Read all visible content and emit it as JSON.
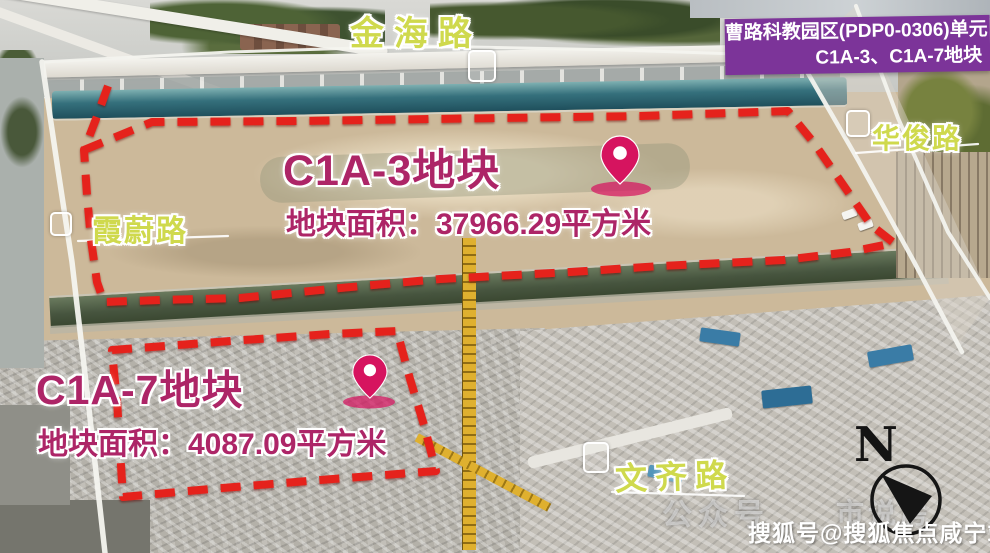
{
  "banner": {
    "line1": "曹路科教园区(PDP0-0306)单元",
    "line2": "C1A-3、C1A-7地块"
  },
  "parcels": [
    {
      "name": "C1A-3",
      "title": "C1A-3地块",
      "area_label": "地块面积：37966.29平方米",
      "area_sqm": 37966.29
    },
    {
      "name": "C1A-7",
      "title": "C1A-7地块",
      "area_label": "地块面积：4087.09平方米",
      "area_sqm": 4087.09
    }
  ],
  "roads": [
    {
      "name": "金海路",
      "position": "top"
    },
    {
      "name": "霞蔚路",
      "position": "left"
    },
    {
      "name": "华俊路",
      "position": "right"
    },
    {
      "name": "文齐路",
      "position": "bottom"
    }
  ],
  "compass": {
    "label": "N"
  },
  "watermarks": {
    "sohu": "搜狐号@搜狐焦点咸宁站",
    "faint_1": "公众号",
    "faint_2": "市说房"
  },
  "colors": {
    "boundary_red": "#e5241a",
    "parcel_text": "#ad2567",
    "road_label": "#cfd94d",
    "banner_bg": "#7c3499",
    "pin": "#d6145f"
  }
}
